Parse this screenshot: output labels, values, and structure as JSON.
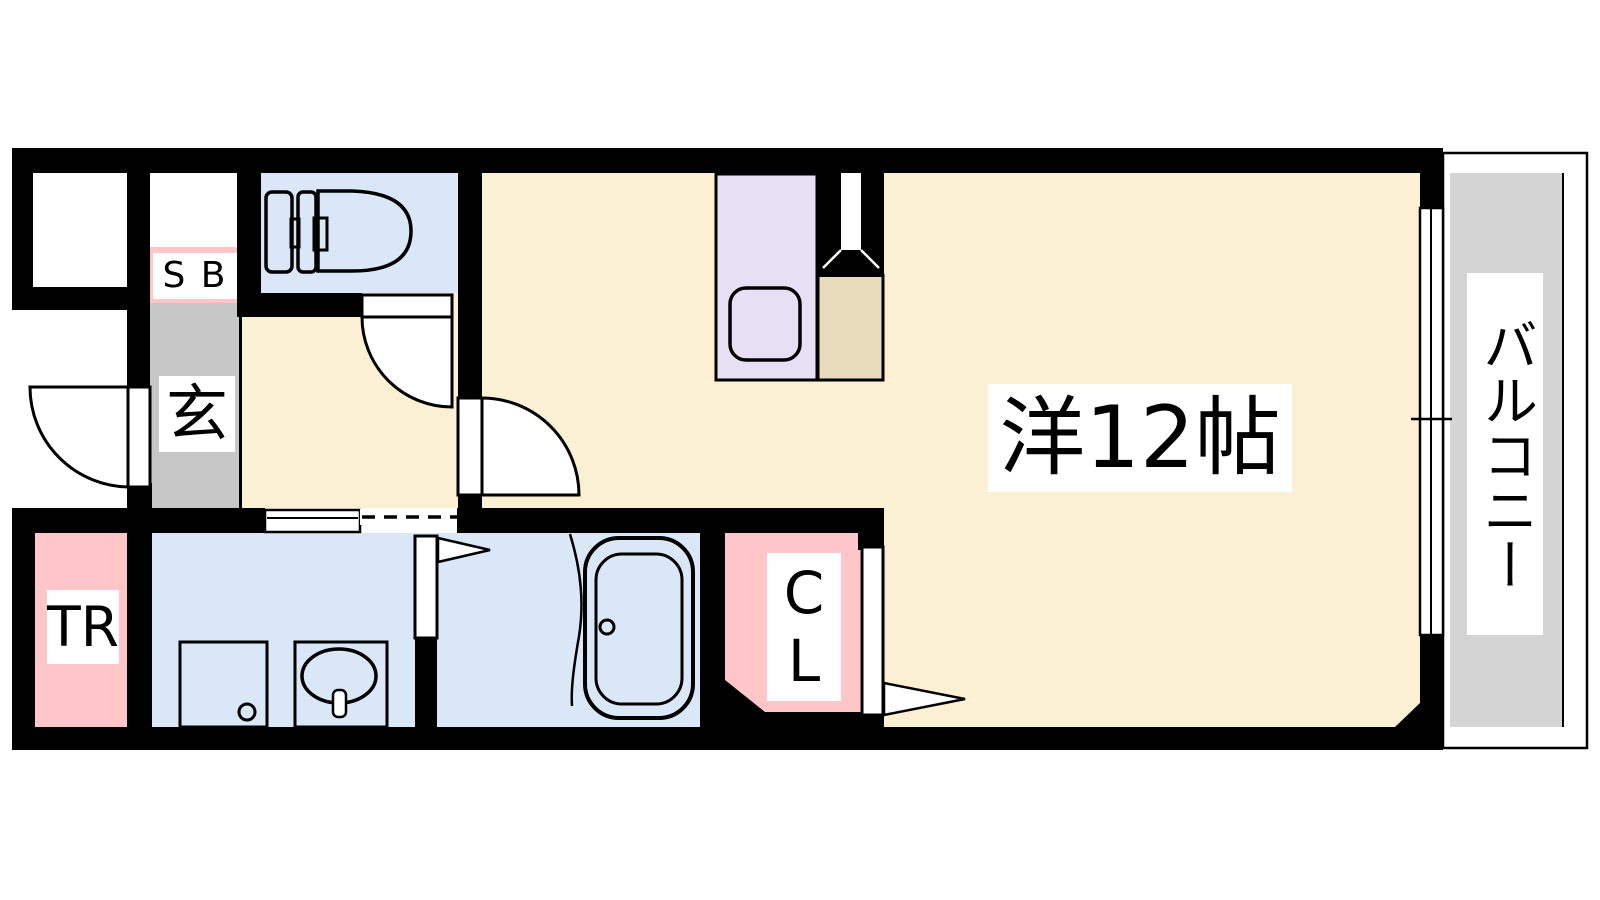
{
  "floor_plan": {
    "title": "1R apartment floor plan",
    "labels": {
      "entrance": "玄",
      "shoe_box": "S B",
      "trunk_room": "TR",
      "closet": "CL",
      "main_room": "洋12帖",
      "balcony": "バルコニー"
    },
    "colors": {
      "wall": "#000000",
      "room_floor": "#FBF0D3",
      "wet_area": "#D9E7F7",
      "kitchen_counter": "#E7DFF3",
      "appliance_space": "#E9DCBD",
      "storage_pink": "#FFC6C9",
      "entrance_gray": "#C7C7C7",
      "balcony_gray": "#D4D4D4",
      "line": "#000000"
    }
  }
}
